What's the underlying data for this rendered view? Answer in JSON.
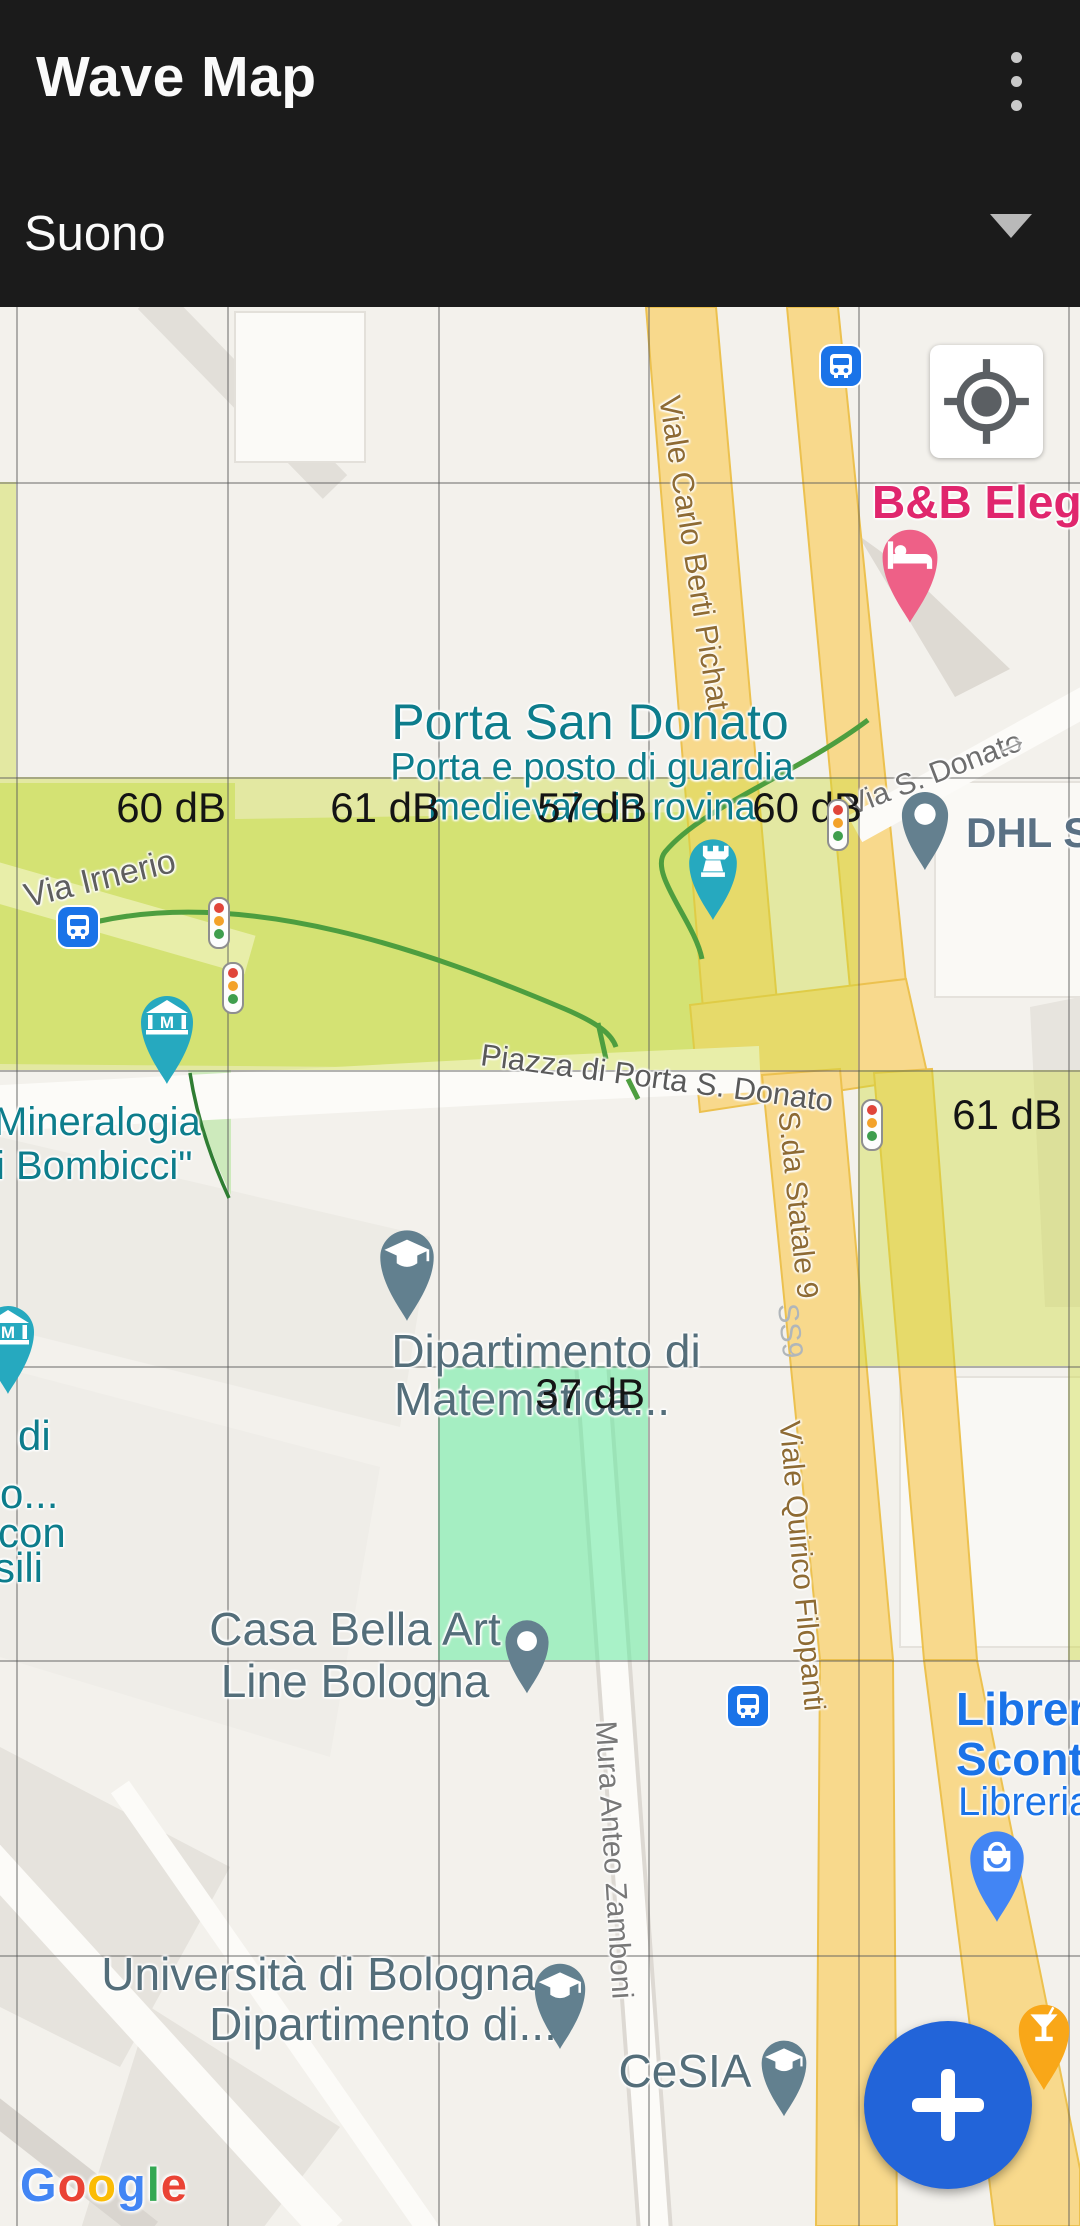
{
  "header": {
    "title": "Wave Map",
    "menu_icon": "kebab-menu",
    "layer": {
      "value": "Suono",
      "icon": "dropdown-caret"
    }
  },
  "controls": {
    "my_location_icon": "gps-crosshair",
    "add_button_icon": "plus"
  },
  "noise": [
    {
      "text": "B"
    },
    {
      "text": "60 dB"
    },
    {
      "text": "61 dB"
    },
    {
      "text": "57 dB"
    },
    {
      "text": "60 dB"
    },
    {
      "text": "61 dB"
    },
    {
      "text": "37 dB"
    }
  ],
  "poi": [
    {
      "text": "B&B Elegan"
    },
    {
      "text": "Porta San Donato"
    },
    {
      "text": "Porta e posto di guardia"
    },
    {
      "text": "medievale in rovina"
    },
    {
      "text": "DHL ST"
    },
    {
      "text": "Mineralogia"
    },
    {
      "text": "i Bombicci\""
    },
    {
      "text": "di"
    },
    {
      "text": "o..."
    },
    {
      "text": "con"
    },
    {
      "text": "sili"
    },
    {
      "text": "Dipartimento di"
    },
    {
      "text": "Matematica..."
    },
    {
      "text": "Casa Bella Art"
    },
    {
      "text": "Line Bologna"
    },
    {
      "text": "Libreria"
    },
    {
      "text": "Sconto"
    },
    {
      "text": "Libreria"
    },
    {
      "text": "Università di Bologna,"
    },
    {
      "text": "Dipartimento di..."
    },
    {
      "text": "CeSIA"
    }
  ],
  "roads": [
    {
      "text": "Via S. Donato"
    },
    {
      "text": "Via Irnerio"
    },
    {
      "text": "Piazza di Porta S. Donato"
    },
    {
      "text": "Viale Carlo Berti Pichat"
    },
    {
      "text": "S.da Statale 9"
    },
    {
      "text": "SS9"
    },
    {
      "text": "Viale Quirico Filopanti"
    },
    {
      "text": "Mura Anteo Zamboni"
    }
  ],
  "attribution": {
    "letters": [
      {
        "ch": "G",
        "color": "#4285F4"
      },
      {
        "ch": "o",
        "color": "#EA4335"
      },
      {
        "ch": "o",
        "color": "#FBBC05"
      },
      {
        "ch": "g",
        "color": "#4285F4"
      },
      {
        "ch": "l",
        "color": "#34A853"
      },
      {
        "ch": "e",
        "color": "#EA4335"
      }
    ]
  },
  "colors": {
    "header_bg": "#1b1b1b",
    "fab_blue": "#2264d9",
    "noise_cell_loud": "#dce73c",
    "noise_cell_quiet": "#64eba0",
    "teal_label": "#0d7d8c",
    "slate_label": "#546e7a",
    "blue_label": "#1a73e8",
    "pink_label": "#e0266d",
    "road_label_brown": "#8e6b34",
    "pin_pink": "#ee6087",
    "pin_teal": "#26a9bf",
    "pin_slate": "#64808f",
    "pin_blue": "#4285f4",
    "pin_orange": "#f9a718",
    "bus_blue": "#1a73e8"
  }
}
